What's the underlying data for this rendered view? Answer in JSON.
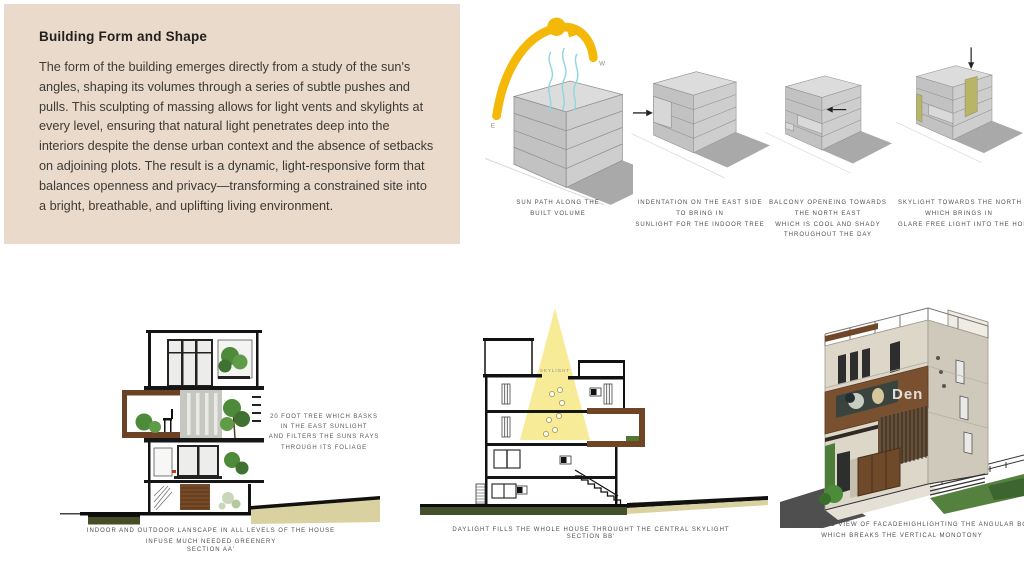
{
  "colors": {
    "panel_bg": "#e9dacc",
    "sun_yellow": "#f4b808",
    "breeze_cyan": "#8fd8de",
    "skylight_olive": "#b9b566",
    "cone_yellow": "#f8ea92",
    "wood_brown": "#6f4526",
    "foliage_green": "#4d8a39",
    "ground_olive": "#474d27",
    "road_khaki": "#d9d2a0",
    "caption_gray": "#4e4e4e"
  },
  "intro": {
    "title": "Building Form and Shape",
    "body": "The form of the building emerges directly from a study of the sun's angles, shaping its volumes through a series of subtle pushes and pulls. This sculpting of massing allows for light vents and skylights at every level, ensuring that natural light penetrates deep into the interiors despite the dense urban context and the absence of setbacks on adjoining plots. The result is a dynamic, light-responsive form that balances openness and privacy—transforming a constrained site into a bright, breathable, and uplifting living environment."
  },
  "sun_diagram": {
    "west_label": "W",
    "east_label": "E",
    "caption": "SUN PATH ALONG THE\nBUILT VOLUME"
  },
  "indentation_diagram": {
    "caption": "INDENTATION ON THE EAST SIDE\nTO BRING IN\nSUNLIGHT FOR THE INDOOR TREE"
  },
  "balcony_diagram": {
    "caption": "BALCONY OPENEING TOWARDS\nTHE NORTH EAST\nWHICH IS COOL AND SHADY\nTHROUGHOUT THE DAY"
  },
  "skylight_diagram": {
    "caption": "SKYLIGHT TOWARDS THE NORTH\nWHICH BRINGS IN\nGLARE FREE LIGHT INTO THE HOM"
  },
  "section_aa": {
    "annotation": "20 FOOT TREE WHICH BASKS\nIN THE EAST SUNLIGHT\nAND FILTERS THE SUNS RAYS\nTHROUGH ITS FOLIAGE",
    "caption": "INDOOR AND OUTDOOR LANSCAPE IN ALL LEVELS OF THE HOUSE\nINFUSE MUCH NEEDED GREENERY",
    "label": "SECTION AA'"
  },
  "section_bb": {
    "skylight_label": "SKYLIGHT",
    "caption": "DAYLIGHT FILLS THE WHOLE HOUSE THROUGHT THE CENTRAL SKYLIGHT",
    "label": "SECTION BB'"
  },
  "axonometric": {
    "caption": "AXONOMETRIC VIEW OF FACADEHIGHLIGHTING THE ANGULAR BOXES\nWHICH BREAKS THE VERTICAL MONOTONY",
    "watermark": "Den"
  }
}
